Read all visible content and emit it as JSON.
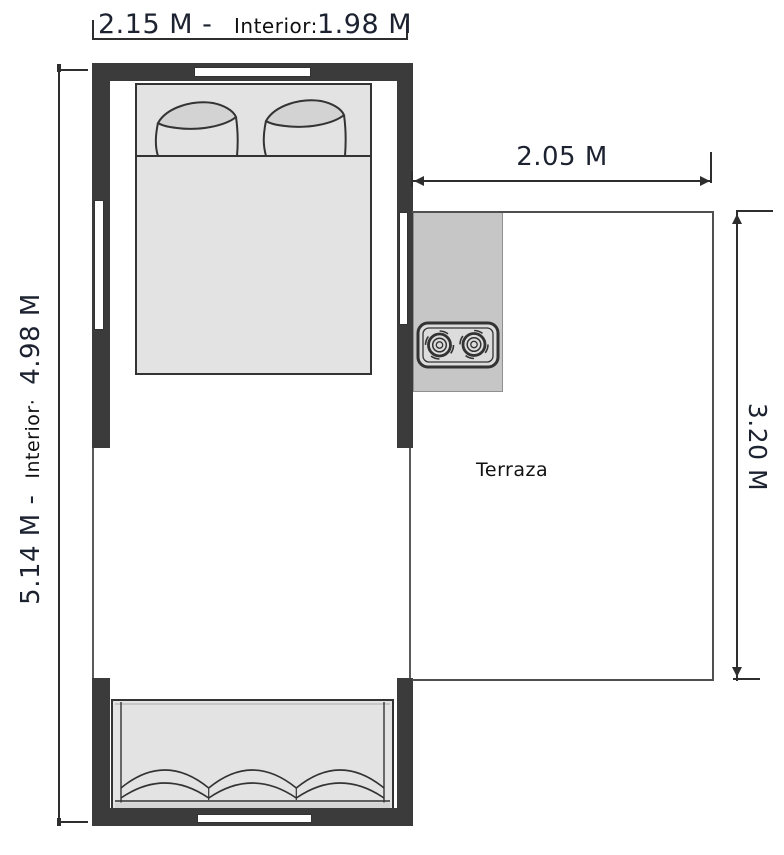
{
  "dimensions": {
    "top_overall": "2.15 M -",
    "top_interior_label": "Interior:",
    "top_interior_value": "1.98 M",
    "left_overall": "5.14 M -",
    "left_interior_label": "Interior·",
    "left_interior_value": "4.98 M",
    "terrace_width": "2.05 M",
    "terrace_height": "3.20 M"
  },
  "labels": {
    "terrace": "Terraza"
  },
  "colors": {
    "background": "#ffffff",
    "wall": "#3b3b3b",
    "line": "#2e2e2e",
    "dim_text": "#1d2230",
    "furniture_fill": "#e3e3e3",
    "pillow_fill": "#d3d3d3",
    "counter_fill": "#c6c6c6",
    "stove_fill": "#dcdcdc",
    "outline": "#333333",
    "terrace_line": "#4f4f4f"
  }
}
